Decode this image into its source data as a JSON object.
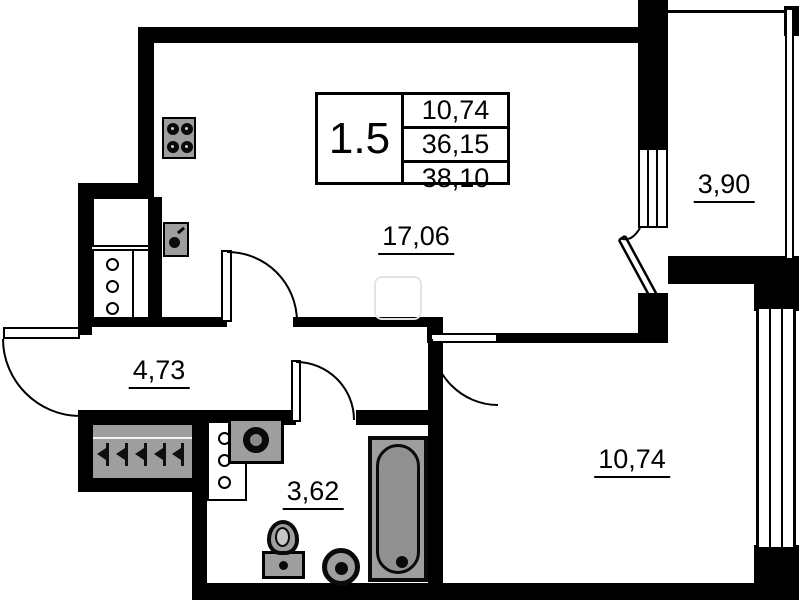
{
  "title_block": {
    "unit_label": "1.5",
    "values": [
      "10,74",
      "36,15",
      "38,10"
    ]
  },
  "rooms": {
    "living_area": "17,06",
    "balcony": "3,90",
    "hallway": "4,73",
    "bathroom": "3,62",
    "bedroom": "10,74"
  },
  "colors": {
    "wall": "#000000",
    "fixture_gray": "#9e9e9e",
    "background": "#ffffff"
  },
  "fixtures": [
    "stove",
    "kitchen-sink",
    "vent-shaft",
    "wardrobe-hangers",
    "entrance-door",
    "washbasin",
    "toilet",
    "washing-machine",
    "bathtub",
    "window",
    "balcony-door"
  ]
}
